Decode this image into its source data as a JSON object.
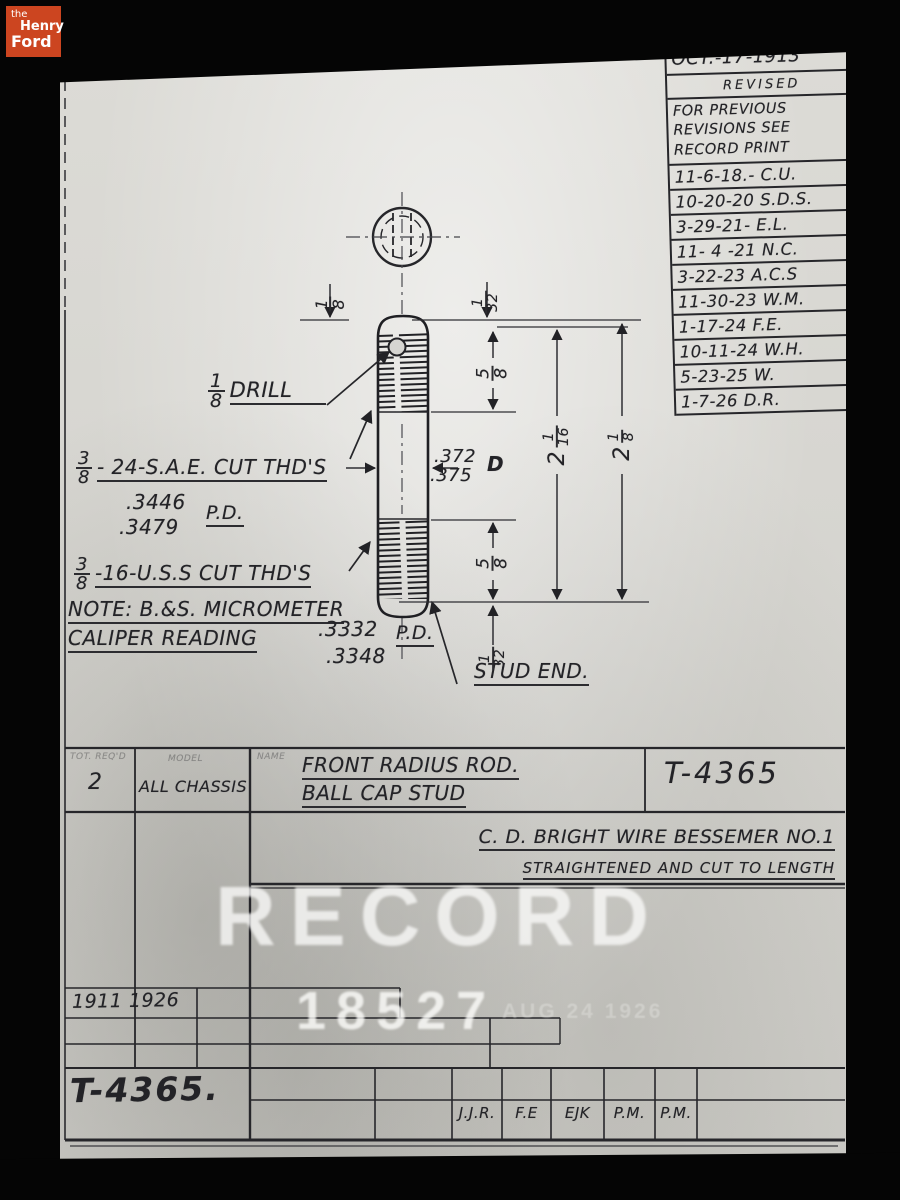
{
  "logo": {
    "the": "the",
    "henry": "Henry",
    "ford": "Ford"
  },
  "revision_table": {
    "date": "OCT.-17-1913",
    "revised": "REVISED",
    "note": [
      "FOR PREVIOUS",
      "REVISIONS SEE",
      "RECORD PRINT"
    ],
    "entries": [
      "11-6-18.- C.U.",
      "10-20-20 S.D.S.",
      "3-29-21- E.L.",
      "11- 4 -21 N.C.",
      "3-22-23 A.C.S",
      "11-30-23 W.M.",
      "1-17-24 F.E.",
      "10-11-24 W.H.",
      "5-23-25 W.",
      "1-7-26 D.R."
    ]
  },
  "callouts": {
    "drill": {
      "num": "1",
      "den": "8",
      "label": "DRILL"
    },
    "sae": {
      "num": "3",
      "den": "8",
      "label": "- 24-S.A.E. CUT THD'S",
      "pd1": ".3446",
      "pd2": ".3479",
      "pd": "P.D."
    },
    "uss": {
      "num": "3",
      "den": "8",
      "label": "-16-U.S.S CUT THD'S"
    },
    "note1": "NOTE: B.&S. MICROMETER",
    "note2": "CALIPER READING",
    "note_pd1": ".3332",
    "note_pd2": ".3348",
    "note_pd": "P.D.",
    "stud_end": "STUD END."
  },
  "dimensions": {
    "cap": {
      "num": "1",
      "den": "8"
    },
    "tip_top": {
      "num": "1",
      "den": "32"
    },
    "upper_thread": {
      "num": "5",
      "den": "8"
    },
    "lower_thread": {
      "num": "5",
      "den": "8"
    },
    "tip_bottom": {
      "num": "1",
      "den": "32"
    },
    "len_inner": {
      "whole": "2",
      "num": "1",
      "den": "16"
    },
    "len_overall": {
      "whole": "2",
      "num": "1",
      "den": "8"
    },
    "dia1": ".372",
    "dia2": ".375",
    "dia_suffix": "D"
  },
  "title_block": {
    "qty_header": "TOT. REQ'D",
    "qty": "2",
    "model_header": "MODEL",
    "model": "ALL CHASSIS",
    "name_header": "NAME",
    "name1": "FRONT RADIUS ROD.",
    "name2": "BALL CAP STUD",
    "part_number": "T-4365",
    "material": "C. D. BRIGHT WIRE BESSEMER NO.1",
    "process": "STRAIGHTENED AND CUT TO LENGTH"
  },
  "stamps": {
    "record": "RECORD",
    "number": "18527",
    "date": "AUG 24 1926"
  },
  "footer": {
    "years": "1911 1926",
    "part_number": "T-4365.",
    "initials": [
      "J.J.R.",
      "F.E",
      "EJK",
      "P.M.",
      "P.M."
    ]
  }
}
